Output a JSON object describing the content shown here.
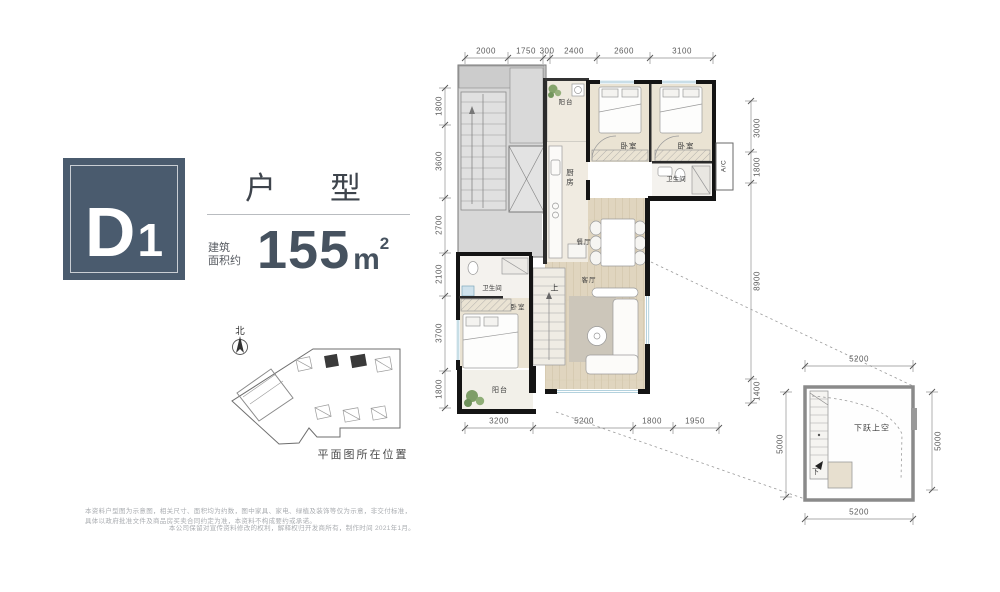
{
  "unit": {
    "code_main": "D",
    "code_sub": "1",
    "title": "户型",
    "area_prefix_line1": "建筑",
    "area_prefix_line2": "面积约",
    "area_value": "155",
    "area_unit": "m",
    "area_sup": "2"
  },
  "colors": {
    "accent": "#4a5b6e",
    "wall": "#141414",
    "common_grey": "#d7d7d7",
    "wood_floor": "#e0d5bf",
    "window_blue": "#a9cbd9"
  },
  "floor_plan": {
    "rooms": {
      "balcony_top": "阳台",
      "kitchen": "厨房",
      "bedroom_a": "卧室",
      "bedroom_b": "卧室",
      "bath_right": "卫生间",
      "ac": "A/C",
      "dining": "餐厅",
      "living": "客厅",
      "stair_up": "上",
      "bath_left": "卫生间",
      "bedroom_c": "卧室",
      "balcony_bottom": "阳台"
    },
    "dims_top": [
      "2000",
      "1750",
      "300",
      "2400",
      "2600",
      "3100"
    ],
    "dims_left": [
      "1800",
      "3600",
      "2700",
      "2100",
      "3700",
      "1800"
    ],
    "dims_bottom": [
      "3200",
      "5200",
      "1800",
      "1950"
    ],
    "dims_right": [
      "3000",
      "1800",
      "8900",
      "1400"
    ]
  },
  "loft_plan": {
    "label": "下跃上空",
    "stair_down": "下",
    "dim_top": "5200",
    "dim_bottom": "5200",
    "dim_left": "5000",
    "dim_right": "5000"
  },
  "site_plan": {
    "north_label": "北",
    "caption": "平面图所在位置"
  },
  "disclaimer": {
    "line1": "本资料户型图为示意图，相关尺寸、面积均为约数，图中家具、家电、绿植及装饰等仅为示意，非交付标准，具体以政府批准文件及商品房买卖合同约定为准，本资料不构成要约或承诺。",
    "line2": "本公司保留对宣传资料修改的权利，解释权归开发商所有，制作时间 2021年1月。"
  }
}
